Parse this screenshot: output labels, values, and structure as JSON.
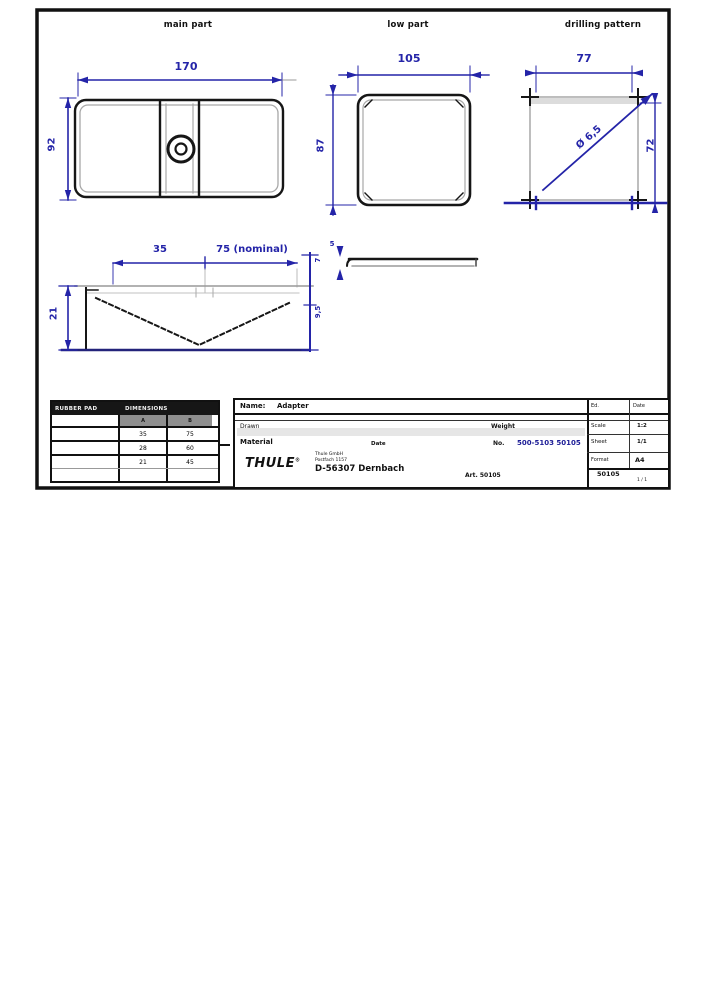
{
  "views": {
    "main_part": {
      "label": "main part",
      "width": "170",
      "height": "92"
    },
    "low_part": {
      "label": "low part",
      "width": "105",
      "height": "87"
    },
    "drilling_pattern": {
      "label": "drilling pattern",
      "width": "77",
      "height": "72",
      "hole": "Ø 6,5"
    },
    "side_profile": {
      "seg_a": "35",
      "seg_b": "75 (nominal)",
      "height": "21",
      "right_top": "7",
      "right_bottom": "9,5"
    },
    "bar_profile": {
      "thickness": "5"
    }
  },
  "parts_table": {
    "col_item": "RUBBER PAD",
    "col_dims": "DIMENSIONS",
    "sub_a": "A",
    "sub_b": "B",
    "rows": [
      {
        "a": "35",
        "b": "75"
      },
      {
        "a": "28",
        "b": "60"
      },
      {
        "a": "21",
        "b": "45"
      },
      {
        "a": "",
        "b": ""
      }
    ]
  },
  "title_block": {
    "name_label": "Name:",
    "name_value": "Adapter",
    "ed_label": "Ed.",
    "date_label": "Date",
    "drawn_label": "Drawn",
    "weight_label": "Weight",
    "date2_label": "Date",
    "material_label": "Material",
    "no_label": "No.",
    "drawing_number": "500-5103 50105",
    "brand": "THULE",
    "brand_reg": "®",
    "company_line1": "Thule GmbH",
    "company_line2": "Postfach 1157",
    "company_bold": "D-56307 Dernbach",
    "scale_label": "Scale",
    "scale_value": "1:2",
    "sheet_label": "Sheet",
    "sheet_value": "1/1",
    "format_label": "Format",
    "format_value": "A4",
    "footer_left": "Art. 50105",
    "footer_number": "50105",
    "footer_page": "1 / 1"
  },
  "colors": {
    "dimension_blue": "#2424a8",
    "line_black": "#161616",
    "line_gray": "#9a9a9a",
    "link_blue": "#1c1c96",
    "table_header_bg": "#161616"
  }
}
